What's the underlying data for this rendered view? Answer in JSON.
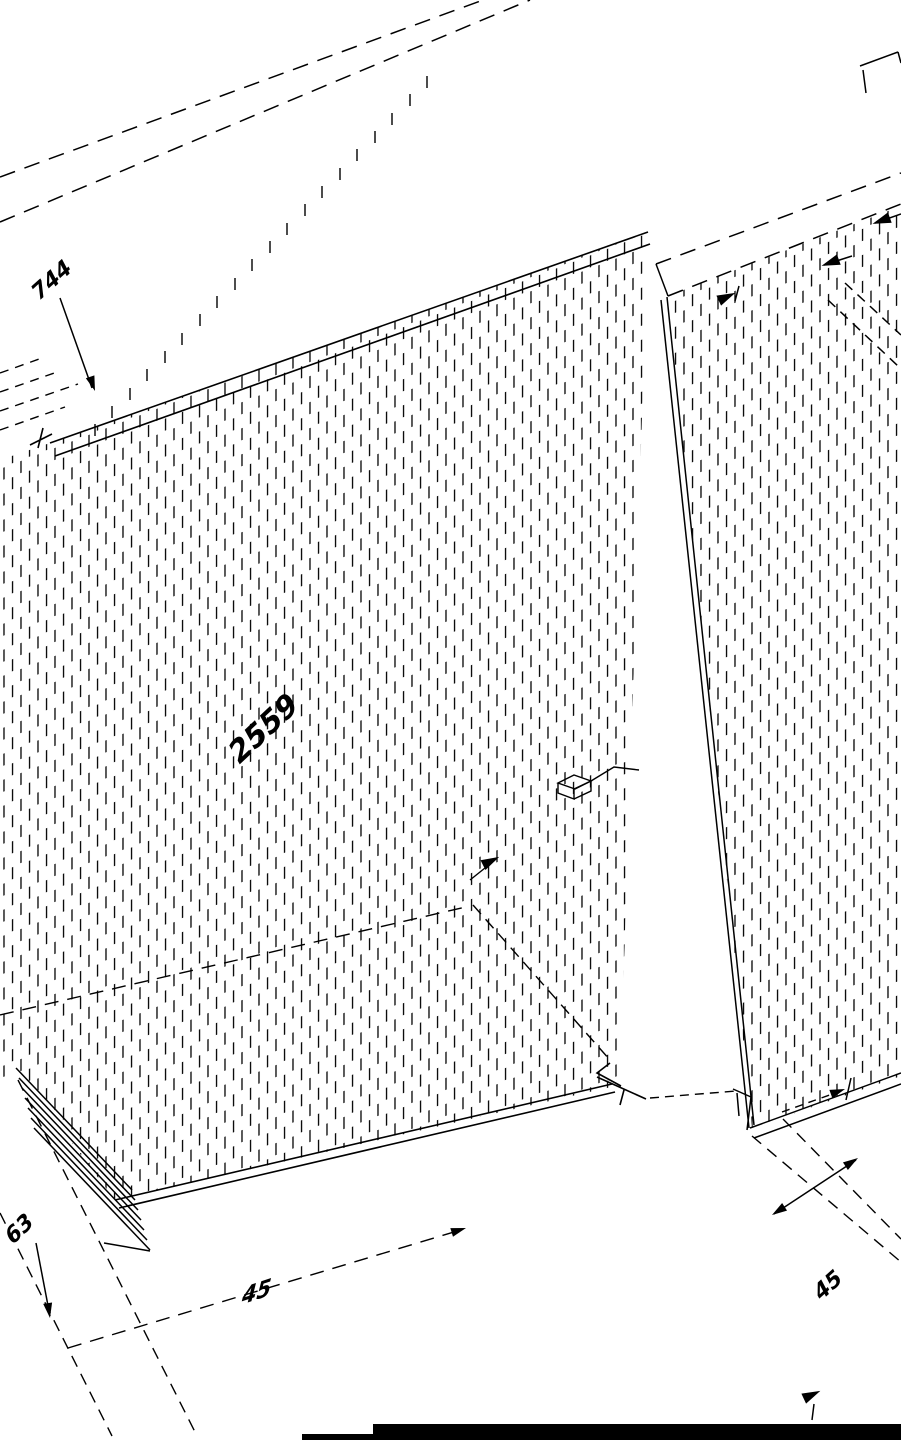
{
  "drawing": {
    "title": "Isometric CAD drawing of timber wall panels with hatching and dimensions",
    "colors": {
      "background": "#ffffff",
      "line": "#000000"
    },
    "dimensions": {
      "top_left_label": "744",
      "length_label": "2559",
      "bottom_left_label": "63",
      "bottom_center_label": "45",
      "bottom_right_label": "45"
    }
  }
}
